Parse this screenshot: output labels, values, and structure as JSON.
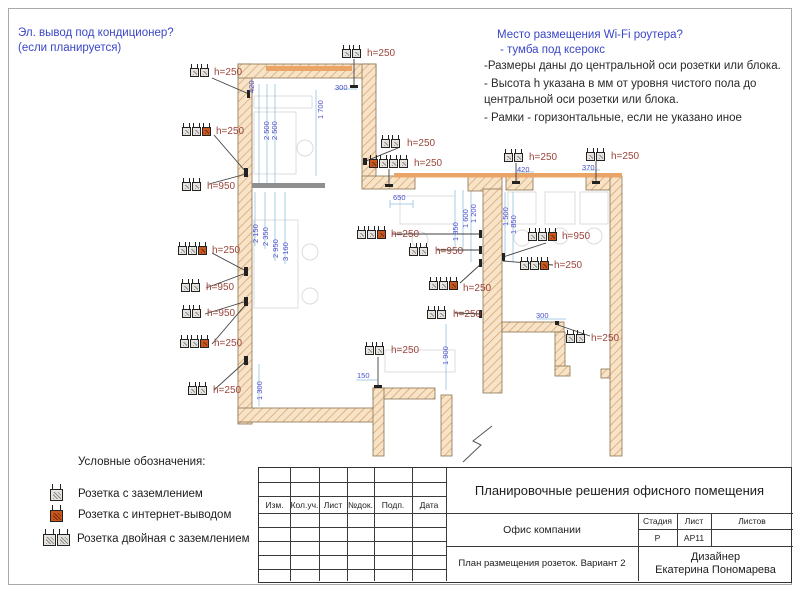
{
  "annotations": {
    "ac_line1": "Эл. вывод под кондиционер?",
    "ac_line2": "(если планируется)",
    "wifi_line1": "Место размещения Wi-Fi роутера?",
    "wifi_line2": "- тумба под ксерокс",
    "note1": "-Размеры даны до центральной оси розетки или блока.",
    "note2": "- Высота h указана в мм от уровня чистого пола до центральной оси розетки или блока.",
    "note3": "- Рамки - горизонтальные, если не указано  иное"
  },
  "legend": {
    "title": "Условные обозначения:"
  },
  "colors": {
    "wall_hatch": "#d89a5e",
    "wall_fill": "#f6e3c8",
    "window_band": "#eaa468",
    "dim_blue": "#4b50c9",
    "socket_label": "#9c453b",
    "annotation_blue": "#3a46c6",
    "internet_module": "#c8581d"
  },
  "plan": {
    "sockets": [
      {
        "x": 190,
        "y": 64,
        "mods": [
          "g",
          "g"
        ],
        "label": "h=250",
        "lx": 214,
        "ly": 67
      },
      {
        "x": 182,
        "y": 123,
        "mods": [
          "g",
          "g",
          "n"
        ],
        "label": "h=250",
        "lx": 216,
        "ly": 126
      },
      {
        "x": 182,
        "y": 178,
        "mods": [
          "g",
          "g"
        ],
        "label": "h=950",
        "lx": 207,
        "ly": 181
      },
      {
        "x": 178,
        "y": 242,
        "mods": [
          "g",
          "g",
          "n"
        ],
        "label": "h=250",
        "lx": 212,
        "ly": 245
      },
      {
        "x": 181,
        "y": 279,
        "mods": [
          "g",
          "g"
        ],
        "label": "h=950",
        "lx": 206,
        "ly": 282
      },
      {
        "x": 182,
        "y": 305,
        "mods": [
          "g",
          "g"
        ],
        "label": "h=950",
        "lx": 207,
        "ly": 308
      },
      {
        "x": 180,
        "y": 335,
        "mods": [
          "g",
          "g",
          "n"
        ],
        "label": "h=250",
        "lx": 214,
        "ly": 338
      },
      {
        "x": 188,
        "y": 382,
        "mods": [
          "g",
          "g"
        ],
        "label": "h=250",
        "lx": 213,
        "ly": 385
      },
      {
        "x": 342,
        "y": 45,
        "mods": [
          "g",
          "g"
        ],
        "label": "h=250",
        "lx": 367,
        "ly": 48
      },
      {
        "x": 381,
        "y": 135,
        "mods": [
          "g",
          "g"
        ],
        "label": "h=250",
        "lx": 407,
        "ly": 138
      },
      {
        "x": 369,
        "y": 155,
        "mods": [
          "n",
          "g",
          "g",
          "g"
        ],
        "label": "h=250",
        "lx": 414,
        "ly": 158
      },
      {
        "x": 504,
        "y": 149,
        "mods": [
          "g",
          "g"
        ],
        "label": "h=250",
        "lx": 529,
        "ly": 152
      },
      {
        "x": 586,
        "y": 148,
        "mods": [
          "g",
          "g"
        ],
        "label": "h=250",
        "lx": 611,
        "ly": 151
      },
      {
        "x": 357,
        "y": 226,
        "mods": [
          "g",
          "g",
          "n"
        ],
        "label": "h=250",
        "lx": 391,
        "ly": 229
      },
      {
        "x": 409,
        "y": 243,
        "mods": [
          "g",
          "g"
        ],
        "label": "h=950",
        "lx": 435,
        "ly": 246
      },
      {
        "x": 429,
        "y": 277,
        "mods": [
          "g",
          "g",
          "n"
        ],
        "label": "h=250",
        "lx": 463,
        "ly": 283
      },
      {
        "x": 427,
        "y": 306,
        "mods": [
          "g",
          "g"
        ],
        "label": "h=250",
        "lx": 453,
        "ly": 309
      },
      {
        "x": 365,
        "y": 342,
        "mods": [
          "g",
          "g"
        ],
        "label": "h=250",
        "lx": 391,
        "ly": 345
      },
      {
        "x": 528,
        "y": 228,
        "mods": [
          "g",
          "g",
          "n"
        ],
        "label": "h=950",
        "lx": 562,
        "ly": 231
      },
      {
        "x": 520,
        "y": 257,
        "mods": [
          "g",
          "g",
          "n"
        ],
        "label": "h=250",
        "lx": 554,
        "ly": 260
      },
      {
        "x": 566,
        "y": 330,
        "mods": [
          "g",
          "g"
        ],
        "label": "h=250",
        "lx": 591,
        "ly": 333
      },
      {
        "x": 50,
        "y": 484,
        "mods": [
          "g"
        ],
        "cls": "lg",
        "label": "Розетка с заземлением",
        "lx": 78,
        "ly": 488,
        "lcls": "ltext"
      },
      {
        "x": 50,
        "y": 505,
        "mods": [
          "n"
        ],
        "cls": "lg",
        "label": "Розетка с интернет-выводом",
        "lx": 78,
        "ly": 509,
        "lcls": "ltext"
      },
      {
        "x": 43,
        "y": 529,
        "mods": [
          "g",
          "g"
        ],
        "cls": "lg",
        "label": "Розетка двойная с заземлением",
        "lx": 77,
        "ly": 533,
        "lcls": "ltext"
      }
    ],
    "dimensions": [
      {
        "text": "420",
        "x": 247,
        "y": 93,
        "rot": true
      },
      {
        "text": "2 500",
        "x": 262,
        "y": 140,
        "rot": true
      },
      {
        "text": "2 500",
        "x": 270,
        "y": 140,
        "rot": true
      },
      {
        "text": "1 700",
        "x": 316,
        "y": 119,
        "rot": true
      },
      {
        "text": "300",
        "x": 335,
        "y": 83
      },
      {
        "text": "2 150",
        "x": 251,
        "y": 243,
        "rot": true
      },
      {
        "text": "2 350",
        "x": 261,
        "y": 246,
        "rot": true
      },
      {
        "text": "2 950",
        "x": 271,
        "y": 258,
        "rot": true
      },
      {
        "text": "3 160",
        "x": 281,
        "y": 261,
        "rot": true
      },
      {
        "text": "1 300",
        "x": 255,
        "y": 400,
        "rot": true
      },
      {
        "text": "150",
        "x": 357,
        "y": 371
      },
      {
        "text": "650",
        "x": 393,
        "y": 193
      },
      {
        "text": "1 850",
        "x": 451,
        "y": 241,
        "rot": true
      },
      {
        "text": "1 600",
        "x": 461,
        "y": 228,
        "rot": true
      },
      {
        "text": "1 200",
        "x": 469,
        "y": 223,
        "rot": true
      },
      {
        "text": "1 500",
        "x": 501,
        "y": 226,
        "rot": true
      },
      {
        "text": "1 850",
        "x": 509,
        "y": 234,
        "rot": true
      },
      {
        "text": "420",
        "x": 517,
        "y": 165
      },
      {
        "text": "370",
        "x": 582,
        "y": 163
      },
      {
        "text": "1 900",
        "x": 441,
        "y": 365,
        "rot": true
      },
      {
        "text": "300",
        "x": 536,
        "y": 311
      }
    ]
  },
  "titleblock": {
    "title": "Планировочные решения офисного помещения",
    "columns": [
      "Изм.",
      "Кол.уч.",
      "Лист",
      "№док.",
      "Подп.",
      "Дата"
    ],
    "object": "Офис компании",
    "stage_label": "Стадия",
    "sheet_label": "Лист",
    "sheets_label": "Листов",
    "stage_value": "Р",
    "sheet_value": "АР11",
    "sheets_value": "",
    "drawing_name": "План размещения розеток. Вариант 2",
    "designer_role": "Дизайнер",
    "designer_name": "Екатерина Пономарева"
  }
}
